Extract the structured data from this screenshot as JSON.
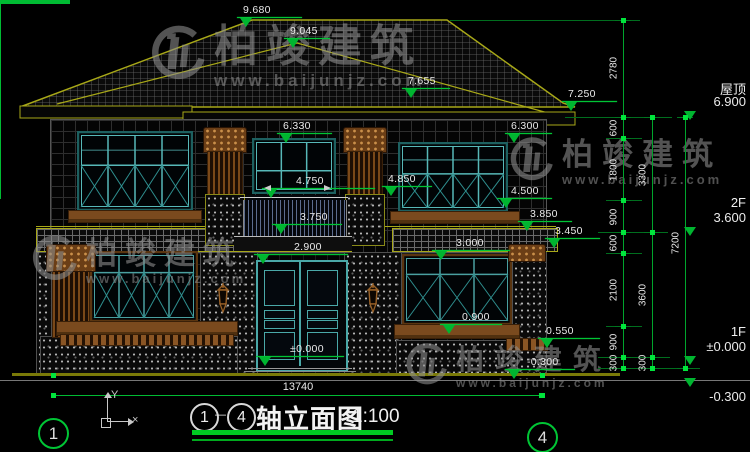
{
  "watermark": {
    "brand": "柏竣建筑",
    "url": "www.baijunjz.com",
    "instances": [
      {
        "x": 146,
        "y": 24,
        "logo": 60,
        "brand_fs": 44,
        "brand_ls": 8,
        "url_fs": 17,
        "url_ls": 4
      },
      {
        "x": 506,
        "y": 136,
        "logo": 48,
        "brand_fs": 31,
        "brand_ls": 9,
        "url_fs": 13,
        "url_ls": 3
      },
      {
        "x": 28,
        "y": 234,
        "logo": 50,
        "brand_fs": 31,
        "brand_ls": 8,
        "url_fs": 13,
        "url_ls": 3
      },
      {
        "x": 402,
        "y": 342,
        "logo": 46,
        "brand_fs": 28,
        "brand_ls": 11,
        "url_fs": 12,
        "url_ls": 3
      }
    ]
  },
  "drawing_title": {
    "axis_start": "1",
    "axis_end": "4",
    "dash": "—",
    "name": "轴立面图",
    "scale": "1:100"
  },
  "axis_bubbles": [
    {
      "label": "1",
      "x": 38,
      "y": 418,
      "line_x": 53,
      "line_y1": 300,
      "line_y2": 418
    },
    {
      "label": "4",
      "x": 527,
      "y": 422,
      "line_x": 542,
      "line_y1": 345,
      "line_y2": 422
    }
  ],
  "total_width_dim": {
    "label": "13740"
  },
  "ucs": {
    "x_label": "×",
    "y_label": "Y"
  },
  "elevation_markers": [
    {
      "label": "9.680",
      "x1": 237,
      "x2": 302,
      "y": 17
    },
    {
      "label": "9.045",
      "x1": 284,
      "x2": 330,
      "y": 38
    },
    {
      "label": "7.655",
      "x1": 402,
      "x2": 450,
      "y": 88
    },
    {
      "label": "7.250",
      "x1": 562,
      "x2": 617,
      "y": 101
    },
    {
      "label": "6.330",
      "x1": 277,
      "x2": 332,
      "y": 133
    },
    {
      "label": "6.300",
      "x1": 505,
      "x2": 552,
      "y": 133
    },
    {
      "label": "4.850",
      "x1": 382,
      "x2": 432,
      "y": 186
    },
    {
      "label": "4.750",
      "x1": 262,
      "x2": 375,
      "y": 188,
      "arrows": true,
      "tdx": 34
    },
    {
      "label": "4.500",
      "x1": 497,
      "x2": 552,
      "y": 198,
      "tdx": 14
    },
    {
      "label": "3.850",
      "x1": 518,
      "x2": 572,
      "y": 221,
      "tdx": 12
    },
    {
      "label": "3.750",
      "x1": 272,
      "x2": 342,
      "y": 224,
      "tdx": 28
    },
    {
      "label": "3.450",
      "x1": 545,
      "x2": 600,
      "y": 238,
      "tdx": 10
    },
    {
      "label": "2.900",
      "x1": 254,
      "x2": 348,
      "y": 254,
      "tdx": 40
    },
    {
      "label": "3.000",
      "x1": 432,
      "x2": 510,
      "y": 250,
      "tdx": 24
    },
    {
      "label": "0.900",
      "x1": 440,
      "x2": 502,
      "y": 324,
      "tdx": 22
    },
    {
      "label": "0.550",
      "x1": 538,
      "x2": 600,
      "y": 338,
      "tdx": 8
    },
    {
      "label": "±0.000",
      "x1": 256,
      "x2": 344,
      "y": 356,
      "tdx": 34
    },
    {
      "label": "-0.300",
      "x1": 505,
      "x2": 575,
      "y": 369,
      "tdx": 22
    }
  ],
  "levels_right": [
    {
      "name": "屋顶",
      "value": "6.900",
      "y": 110
    },
    {
      "name": "2F",
      "value": "3.600",
      "y": 226
    },
    {
      "name": "1F",
      "value": "±0.000",
      "y": 355
    },
    {
      "name": "",
      "value": "-0.300",
      "y": 377,
      "below": true
    }
  ],
  "dim_chains": [
    {
      "x": 623,
      "y1": 20,
      "y2": 368,
      "ticks": [
        20,
        117,
        138,
        200,
        232,
        253,
        326,
        357,
        368
      ],
      "segments": [
        {
          "label": "2780",
          "y": 68
        },
        {
          "label": "600",
          "y": 128
        },
        {
          "label": "1800",
          "y": 170
        },
        {
          "label": "900",
          "y": 217
        },
        {
          "label": "600",
          "y": 243
        },
        {
          "label": "2100",
          "y": 290
        },
        {
          "label": "900",
          "y": 342
        },
        {
          "label": "300",
          "y": 363
        }
      ]
    },
    {
      "x": 652,
      "y1": 117,
      "y2": 368,
      "ticks": [
        117,
        232,
        357,
        368
      ],
      "segments": [
        {
          "label": "3300",
          "y": 175
        },
        {
          "label": "3600",
          "y": 295
        },
        {
          "label": "300",
          "y": 363
        }
      ]
    },
    {
      "x": 685,
      "y1": 117,
      "y2": 368,
      "ticks": [
        117,
        368
      ],
      "segments": [
        {
          "label": "7200",
          "y": 243
        }
      ]
    }
  ],
  "extension_lines": [
    [
      450,
      640,
      20
    ],
    [
      565,
      672,
      117
    ],
    [
      606,
      642,
      138
    ],
    [
      606,
      642,
      200
    ],
    [
      598,
      668,
      232
    ],
    [
      606,
      642,
      253
    ],
    [
      606,
      642,
      326
    ],
    [
      598,
      670,
      357
    ],
    [
      598,
      700,
      368
    ]
  ],
  "colors": {
    "dim_green": "#00c535",
    "roof_olive": "#a8a818",
    "window_teal": "#57b8b8",
    "trim_brown": "#7a4a1e",
    "watermark_gray": "#8f8f8f",
    "baluster_blue": "#5c6c8e"
  }
}
